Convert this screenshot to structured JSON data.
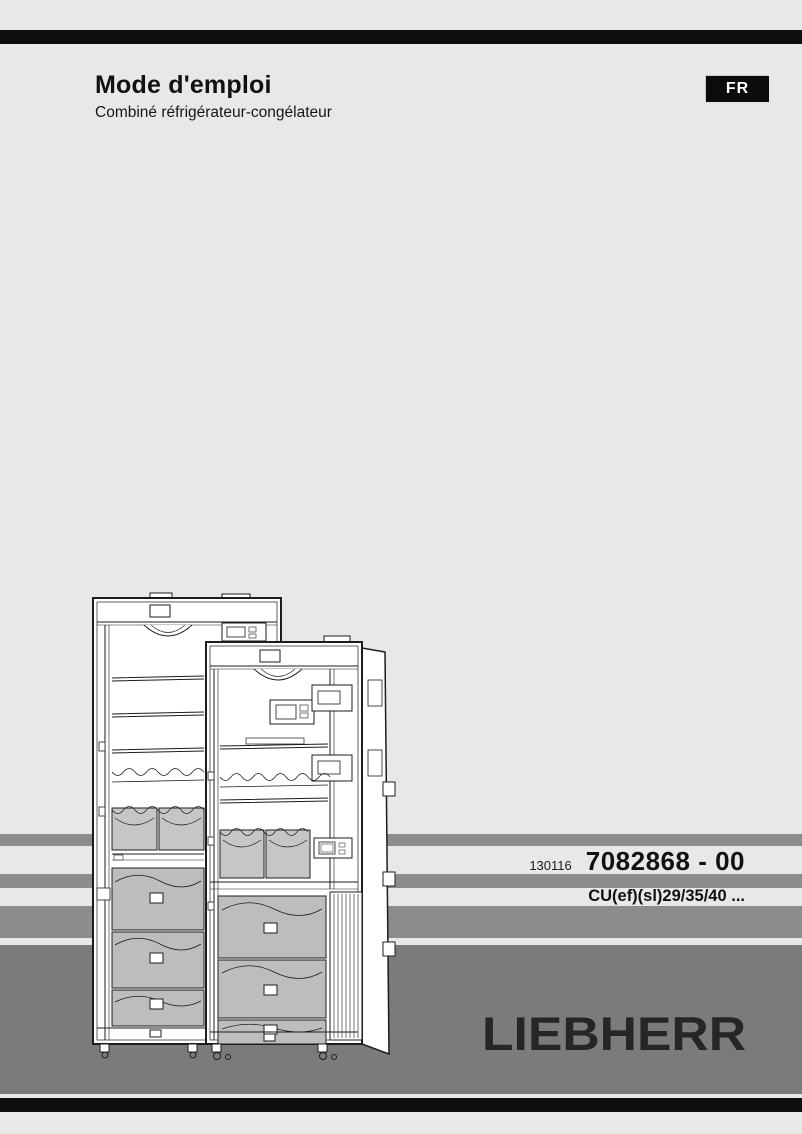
{
  "header": {
    "title": "Mode d'emploi",
    "subtitle": "Combiné réfrigérateur-congélateur",
    "language_badge": "FR"
  },
  "product": {
    "date_code": "130116",
    "part_number": "7082868 - 00",
    "model_range": "CU(ef)(sl)29/35/40 ..."
  },
  "brand": {
    "logo": "LIEBHERR"
  },
  "illustration": {
    "description": "line drawing of two open fridge-freezer combinations"
  },
  "colors": {
    "background": "#e8e8e8",
    "edge_bar_dark": "#0e0e0e",
    "stripe_gray": "#8c8c8c",
    "footer_gray": "#7b7b7b",
    "text_dark": "#111111",
    "logo_dark": "#262626"
  }
}
